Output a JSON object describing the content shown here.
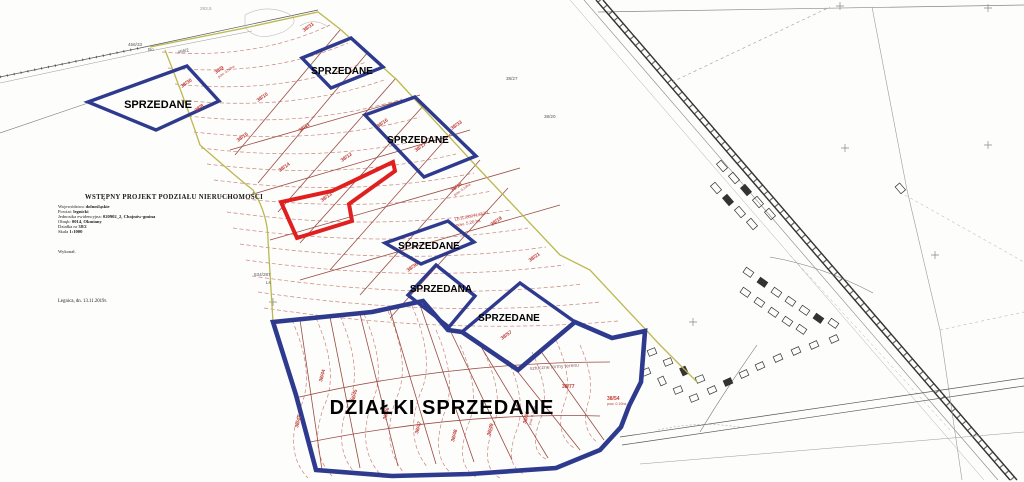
{
  "document": {
    "title": "WSTĘPNY PROJEKT PODZIAŁU NIERUCHOMOŚCI",
    "fields": [
      {
        "label": "Województwo",
        "value": "dolnośląskie"
      },
      {
        "label": "Powiat:",
        "value": "legnicki"
      },
      {
        "label": "Jednostka ewidencyjna:",
        "value": "020902_2, Chojnów-gmina"
      },
      {
        "label": "Obręb:",
        "value": "0014, Okmiany"
      },
      {
        "label": "Działka nr",
        "value": "38/2"
      },
      {
        "label": "Skala",
        "value": "1:1000"
      }
    ],
    "author_line": "Wykonał.",
    "place_date": "Legnica, dn. 13.11.2019r."
  },
  "sold": {
    "left": "SPRZEDANE",
    "top": "SPRZEDANE",
    "upper_right": "SPRZEDANE",
    "middle": "SPRZEDANE",
    "middle_a": "SPRZEDANA",
    "lower": "SPRZEDANE",
    "big_area": "DZIAŁKI SPRZEDANE"
  },
  "annotations": {
    "kw_number": "LE1L/00071433/1",
    "kw_area": "pow. 5,20 ha",
    "terrain": "sztuczne formy terenu",
    "p456_33": "456/33",
    "p456_33_use": "Bo",
    "p456_2": "456/2",
    "p534_287": "534/287",
    "p534_287_use": "Ls",
    "p38_27": "38/27",
    "p38_20": "38/20",
    "elev": "293,5"
  },
  "parcels": [
    {
      "t": "38/8"
    },
    {
      "t": "38/9",
      "a": "pow. 0,50ha"
    },
    {
      "t": "38/10"
    },
    {
      "t": "38/11"
    },
    {
      "t": "38/12"
    },
    {
      "t": "38/13"
    },
    {
      "t": "38/14"
    },
    {
      "t": "38/15"
    },
    {
      "t": "38/16"
    },
    {
      "t": "38/17"
    },
    {
      "t": "38/18",
      "a": "pow. 0,10ha"
    },
    {
      "t": "38/19"
    },
    {
      "t": "38/21"
    },
    {
      "t": "38/30"
    },
    {
      "t": "38/31"
    },
    {
      "t": "38/33"
    },
    {
      "t": "38/36"
    },
    {
      "t": "38/57"
    },
    {
      "t": "38/44"
    },
    {
      "t": "38/45"
    },
    {
      "t": "38/46"
    },
    {
      "t": "38/47"
    },
    {
      "t": "38/48"
    },
    {
      "t": "38/49"
    },
    {
      "t": "38/55",
      "a": "pow. 0,10ha"
    },
    {
      "t": "38/77"
    },
    {
      "t": "38/54",
      "a": "pow. 0,10ha"
    },
    {
      "t": "38/43"
    }
  ],
  "colors": {
    "sold_outline": "#2e3a8e",
    "highlight": "#e01f1f",
    "boundary": "#bcb84e",
    "contours": "#c9857d",
    "subdivision": "#9c4a42",
    "labels_red": "#c03a32",
    "ink": "#444444"
  }
}
